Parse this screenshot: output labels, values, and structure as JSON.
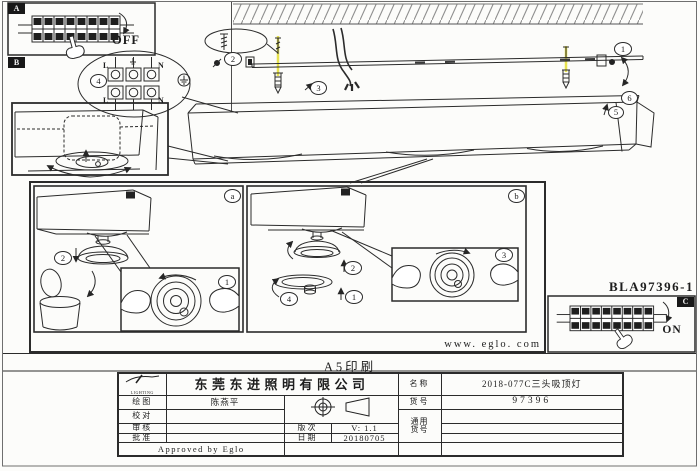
{
  "page": {
    "print_note": "A5印刷",
    "website": "www. eglo. com",
    "model_code": "BLA97396-1"
  },
  "colors": {
    "highlight": "#e7e24f"
  },
  "sections": {
    "a_label": "A",
    "off": "OFF",
    "b_label": "B",
    "c_label": "C",
    "on": "ON"
  },
  "wiring": {
    "step": "4",
    "l_top": "L",
    "n_top": "N",
    "l_bottom": "L",
    "n_bottom": "N"
  },
  "mounting": {
    "step1": "1",
    "step2": "2",
    "step3": "3",
    "step5": "5",
    "step6": "6"
  },
  "panel_a": {
    "label": "a",
    "step1": "1",
    "step2": "2"
  },
  "panel_b": {
    "label": "b",
    "step1": "1",
    "step2": "2",
    "step3": "3",
    "step4": "4"
  },
  "title_block": {
    "company": "东莞东进照明有限公司",
    "logo_subtext": "LIGHTING",
    "draw_label": "绘图",
    "draw_value": "陈燕平",
    "check_label": "校对",
    "review_label": "审核",
    "approve_label": "批准",
    "version_label": "版次",
    "version_value": "V: 1.1",
    "date_label": "日期",
    "date_value": "20180705",
    "name_label": "名称",
    "name_value": "2018-077C三头吸顶灯",
    "item_label": "货号",
    "item_value": "97396",
    "generic_label_line1": "通用",
    "generic_label_line2": "货号",
    "approved_note": "Approved by Eglo"
  }
}
